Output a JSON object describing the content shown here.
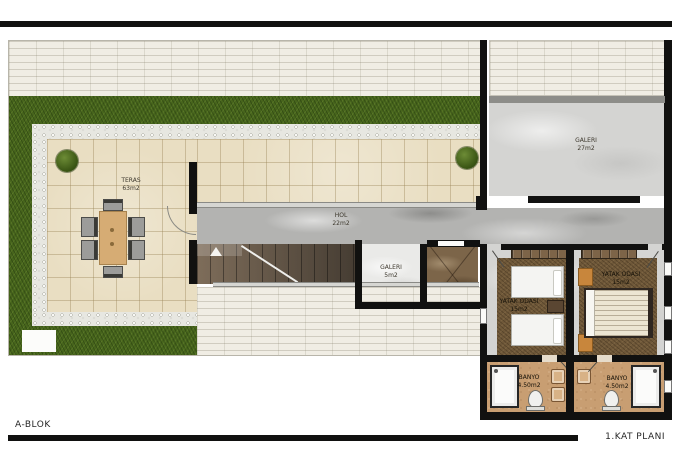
{
  "footer": {
    "block_label": "A-BLOK",
    "plan_title": "1.KAT PLANI"
  },
  "rooms": {
    "teras": {
      "label": "TERAS",
      "area": "63m2"
    },
    "hol": {
      "label": "HOL",
      "area": "22m2"
    },
    "galeri_small": {
      "label": "GALERI",
      "area": "5m2"
    },
    "galeri_large": {
      "label": "GALERI",
      "area": "27m2"
    },
    "yatak_left": {
      "label": "YATAK ODASI",
      "area": "15m2"
    },
    "yatak_right": {
      "label": "YATAK ODASI",
      "area": "15m2"
    },
    "banyo_left": {
      "label": "BANYO",
      "area": "4.50m2"
    },
    "banyo_right": {
      "label": "BANYO",
      "area": "4.50m2"
    }
  },
  "colors": {
    "wall": "#111110",
    "grass": "#47651c",
    "terrace_tile": "#e9dec2",
    "paving_brick": "#f0ede4",
    "pebble": "#e7e7e1",
    "hall_marble": "#b3b3b1",
    "gallery_marble": "#d4d4d2",
    "elevator_marble": "#7c6549",
    "bedroom_rug": "#6f5839",
    "bathroom_floor": "#c89e72",
    "accent_wood": "#c8863c"
  }
}
